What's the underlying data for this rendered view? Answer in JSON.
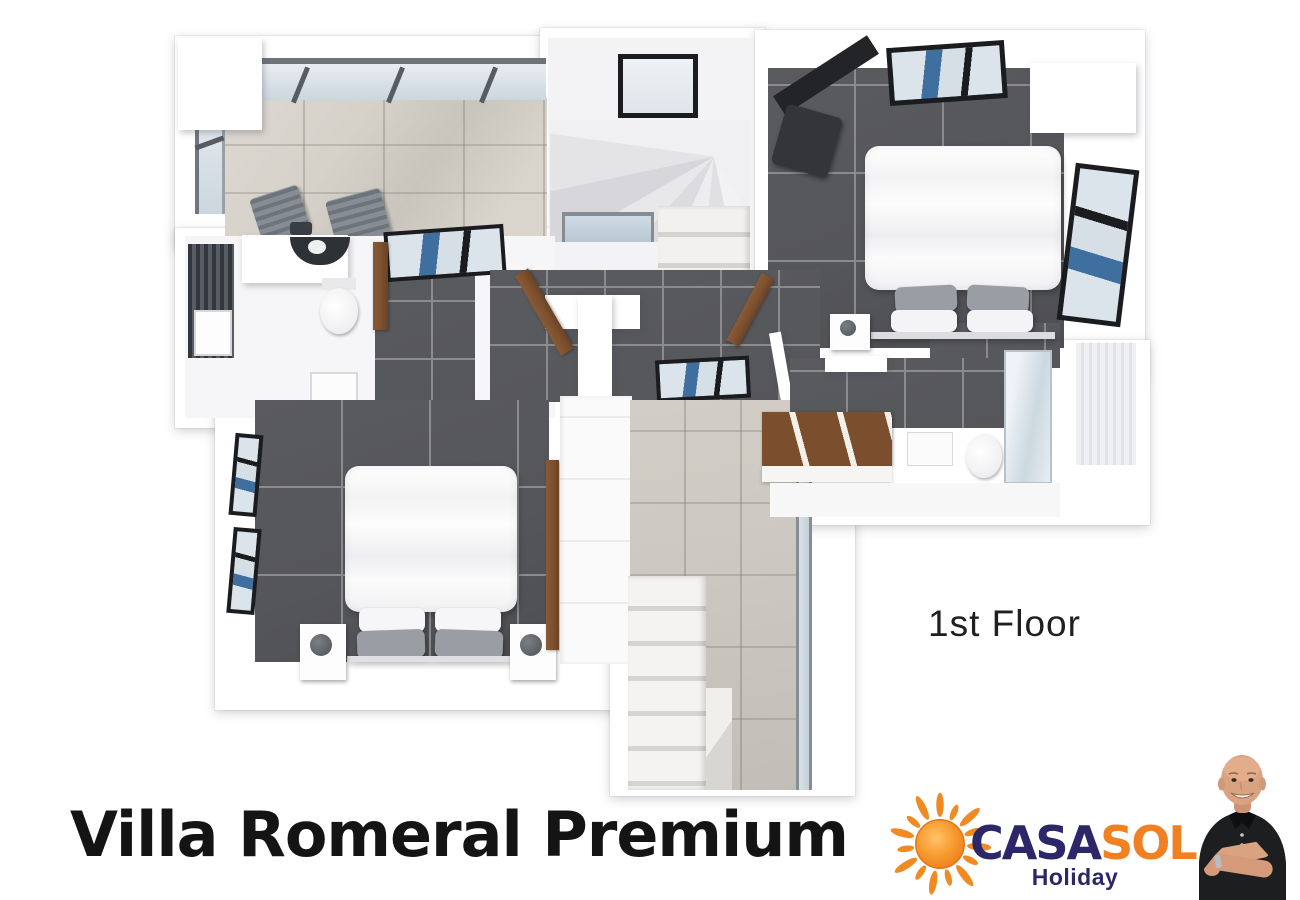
{
  "title": "Villa Romeral Premium",
  "floor_label": "1st Floor",
  "logo": {
    "brand_casa": "CASA",
    "brand_sol": "SOL",
    "subtitle": "Holiday",
    "icon": "sun-icon"
  },
  "floor_plan": {
    "type": "3d-top-down-floor-plan",
    "rooms": [
      "terrace",
      "staircase",
      "bedroom-top-right",
      "bathroom-left",
      "bedroom-bottom-left",
      "hallway-with-stairs",
      "bathroom-right-with-walk-in-closet"
    ]
  },
  "photo": {
    "description": "smiling bald man, black polo shirt, arms crossed, wristwatch"
  },
  "colors": {
    "page_bg": "#ffffff",
    "text_dark": "#1a1a1a",
    "brand_navy": "#2b2769",
    "brand_orange": "#f08021",
    "sun_core": "#f7941d",
    "sun_deep": "#e8761a",
    "dark_tile": "#55565a",
    "tile_line": "#8a8b8d",
    "marble": "#d6d2ca",
    "hall_marble": "#ccc8c1",
    "wall_white": "#ffffff",
    "frame_black": "#1b1c20",
    "glass_blue": "#3f6f9f",
    "glass_light": "#dce4eb",
    "wood": "#7b4f2e",
    "lounger_gray": "#7d838a",
    "pillow_gray": "#9a9da3",
    "skin": "#d9a281",
    "shirt": "#1d1e20"
  }
}
